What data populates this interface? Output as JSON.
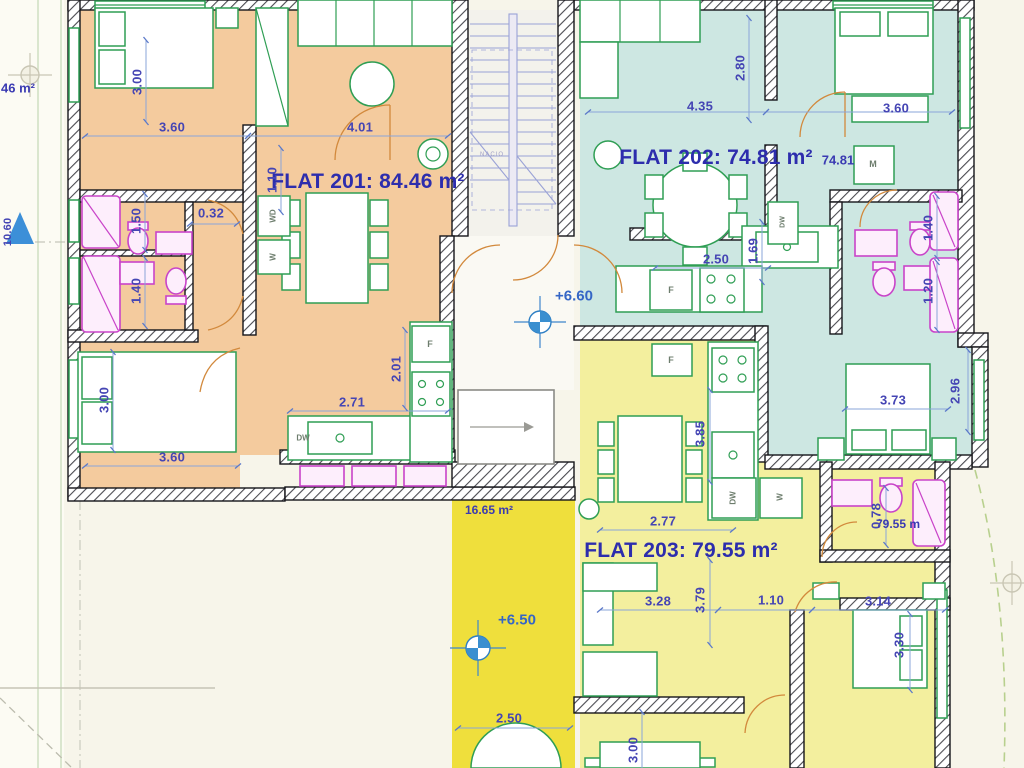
{
  "flats": {
    "flat201": {
      "label": "FLAT 201: 84.46 m²",
      "color": "#f4cb9e"
    },
    "flat202": {
      "label": "FLAT 202: 74.81 m²",
      "color": "#cde7e2"
    },
    "flat203": {
      "label": "FLAT 203: 79.55 m²",
      "color": "#f3ef9e"
    }
  },
  "annotations": {
    "area_202_small": "74.81",
    "area_203_small": "79.55 m",
    "terrace_area": "16.65 m²",
    "left_area_partial": "46 m²",
    "level_upper": "+6.60",
    "level_terrace": "+6.50",
    "elevation_left": "10.60",
    "stair_text": "NACIO"
  },
  "appliances": {
    "wd": "WD",
    "w": "W",
    "f": "F",
    "dw": "DW",
    "m": "M"
  },
  "dims": {
    "d032": "0.32",
    "d360": "3.60",
    "d401": "4.01",
    "d271": "2.71",
    "d435": "4.35",
    "d250": "2.50",
    "d373": "3.73",
    "d277": "2.77",
    "d328": "3.28",
    "d110": "1.10",
    "d314": "3.14",
    "v300": "3.00",
    "v110": "1.10",
    "v150": "1.50",
    "v140": "1.40",
    "v201": "2.01",
    "v280": "2.80",
    "v169": "1.69",
    "v120": "1.20",
    "v296": "2.96",
    "v385": "3.85",
    "v379": "3.79",
    "v330": "3.30",
    "v078": "0.78"
  },
  "colors": {
    "terrace_yellow": "#efdf3c",
    "wall": "#15151a",
    "dimension_blue": "#4545b4",
    "furniture_green": "#2f9e54",
    "fixture_magenta": "#c943c9",
    "door_orange": "#d2893c"
  }
}
